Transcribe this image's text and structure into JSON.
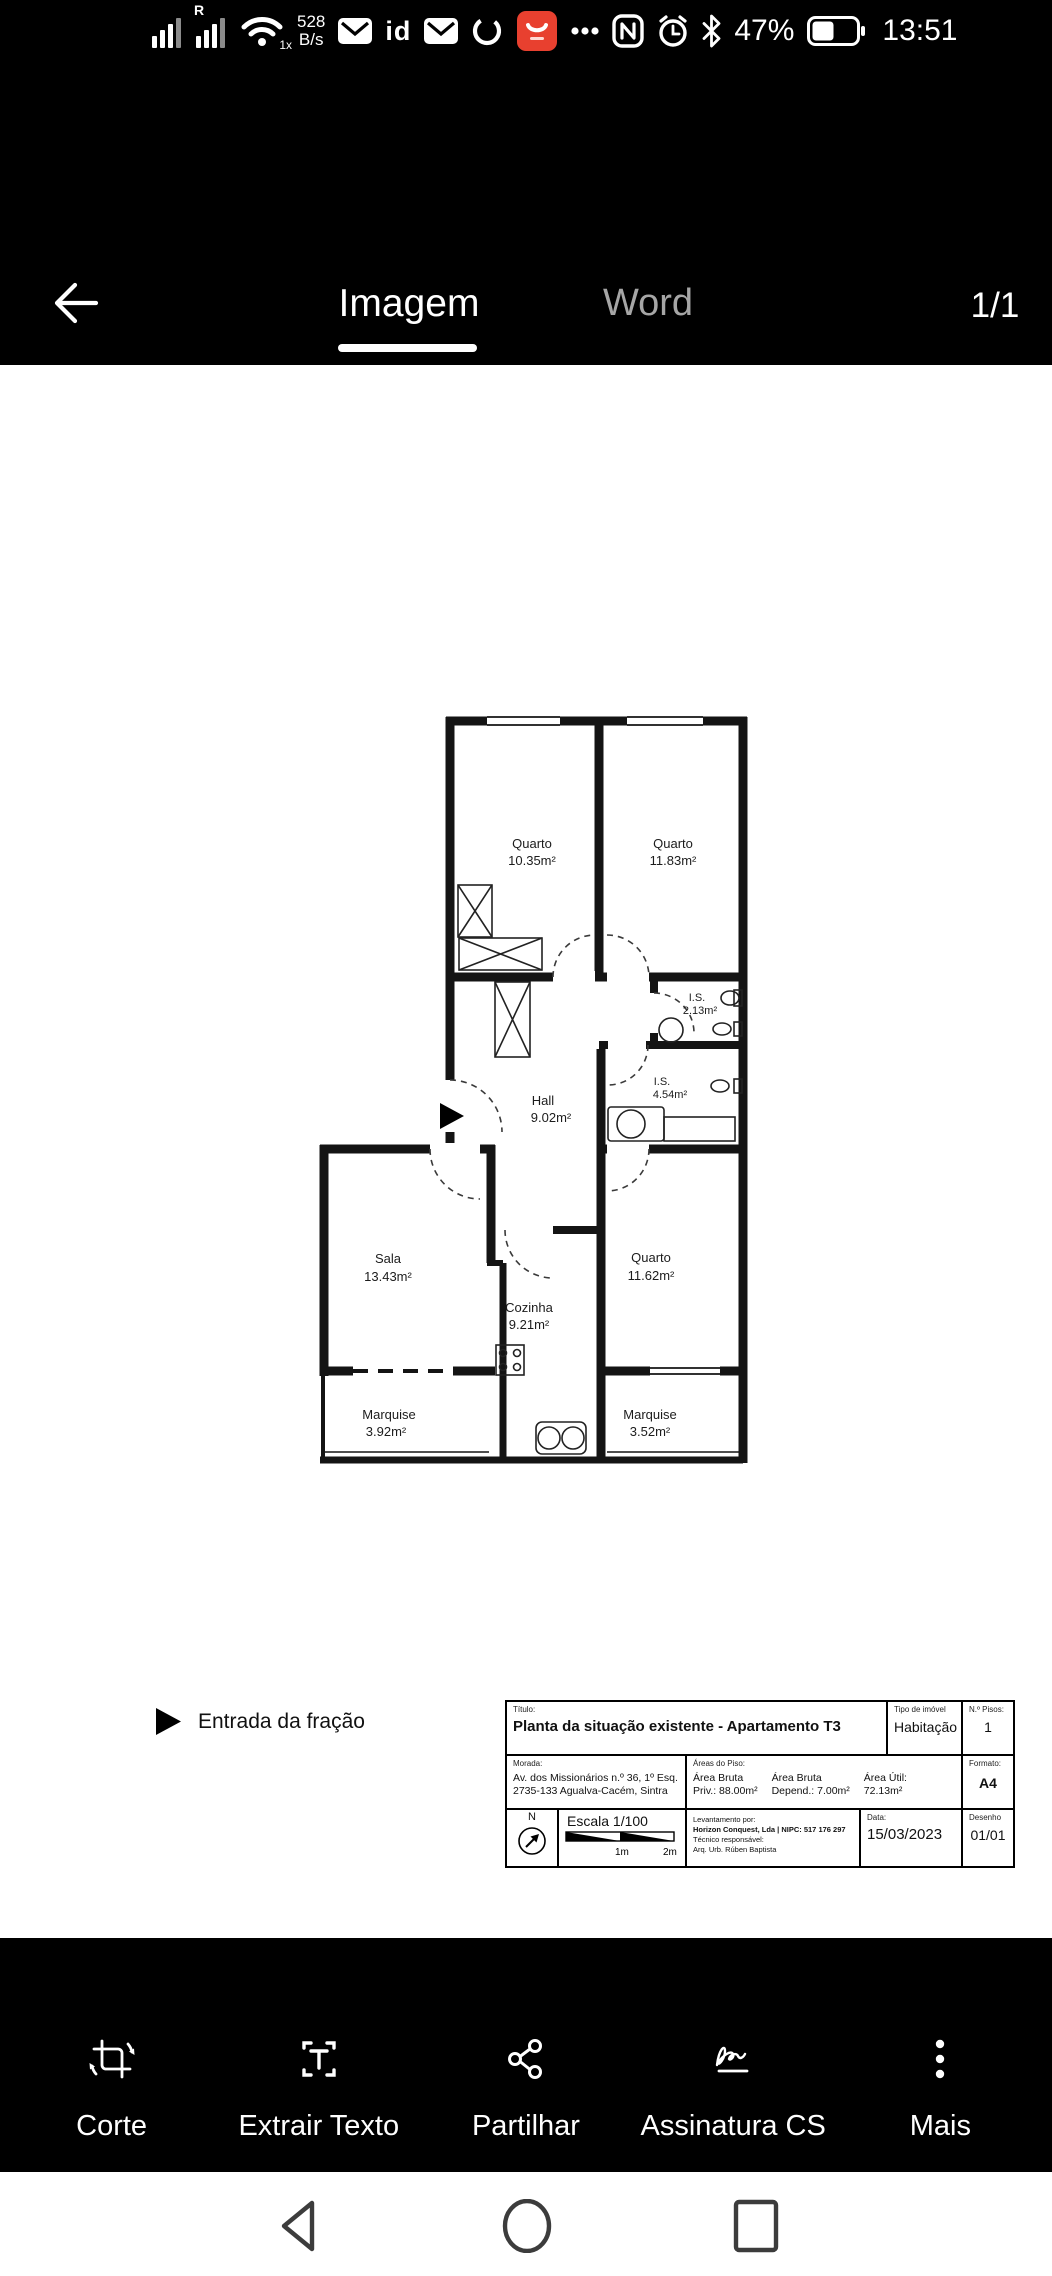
{
  "status_bar": {
    "roaming": "R",
    "wifi_badge": "1x",
    "network_speed_value": "528",
    "network_speed_unit": "B/s",
    "id_label": "id",
    "battery_percent": "47%",
    "time": "13:51"
  },
  "header": {
    "tabs": [
      {
        "label": "Imagem",
        "active": true
      },
      {
        "label": "Word",
        "active": false
      }
    ],
    "page_indicator": "1/1"
  },
  "floor_plan": {
    "rooms": {
      "quarto1": {
        "name": "Quarto",
        "area": "10.35m²"
      },
      "quarto2": {
        "name": "Quarto",
        "area": "11.83m²"
      },
      "is1": {
        "name": "I.S.",
        "area": "2.13m²"
      },
      "is2": {
        "name": "I.S.",
        "area": "4.54m²"
      },
      "hall": {
        "name": "Hall",
        "area": "9.02m²"
      },
      "sala": {
        "name": "Sala",
        "area": "13.43m²"
      },
      "cozinha": {
        "name": "Cozinha",
        "area": "9.21m²"
      },
      "quarto3": {
        "name": "Quarto",
        "area": "11.62m²"
      },
      "marquise1": {
        "name": "Marquise",
        "area": "3.92m²"
      },
      "marquise2": {
        "name": "Marquise",
        "area": "3.52m²"
      }
    },
    "entrance_legend": "Entrada da fração",
    "title_block": {
      "titulo_label": "Título:",
      "titulo": "Planta da situação existente - Apartamento T3",
      "tipo_label": "Tipo de imóvel",
      "tipo": "Habitação",
      "pisos_label": "N.º Pisos:",
      "pisos": "1",
      "morada_label": "Morada:",
      "morada_line1": "Av. dos Missionários n.º 36, 1º Esq.",
      "morada_line2": "2735-133 Agualva-Cacém, Sintra",
      "areas_label": "Áreas do Piso:",
      "area_bruta_priv_l1": "Área Bruta",
      "area_bruta_priv_l2": "Priv.: 88.00m²",
      "area_bruta_dep_l1": "Área Bruta",
      "area_bruta_dep_l2": "Depend.: 7.00m²",
      "area_util_l1": "Área Útil:",
      "area_util_l2": "72.13m²",
      "formato_label": "Formato:",
      "formato": "A4",
      "north_label": "N",
      "escala": "Escala 1/100",
      "scale_tick1": "1m",
      "scale_tick2": "2m",
      "levantamento_label": "Levantamento por:",
      "levantamento": "Horizon Conquest, Lda | NIPC: 517 176 297",
      "tecnico_label": "Técnico responsável:",
      "tecnico": "Arq. Urb. Rúben Baptista",
      "data_label": "Data:",
      "data": "15/03/2023",
      "desenho_label": "Desenho",
      "desenho": "01/01"
    }
  },
  "toolbar": {
    "items": [
      {
        "label": "Corte"
      },
      {
        "label": "Extrair Texto"
      },
      {
        "label": "Partilhar"
      },
      {
        "label": "Assinatura CS"
      },
      {
        "label": "Mais"
      }
    ]
  },
  "colors": {
    "accent_red": "#e8402f"
  }
}
